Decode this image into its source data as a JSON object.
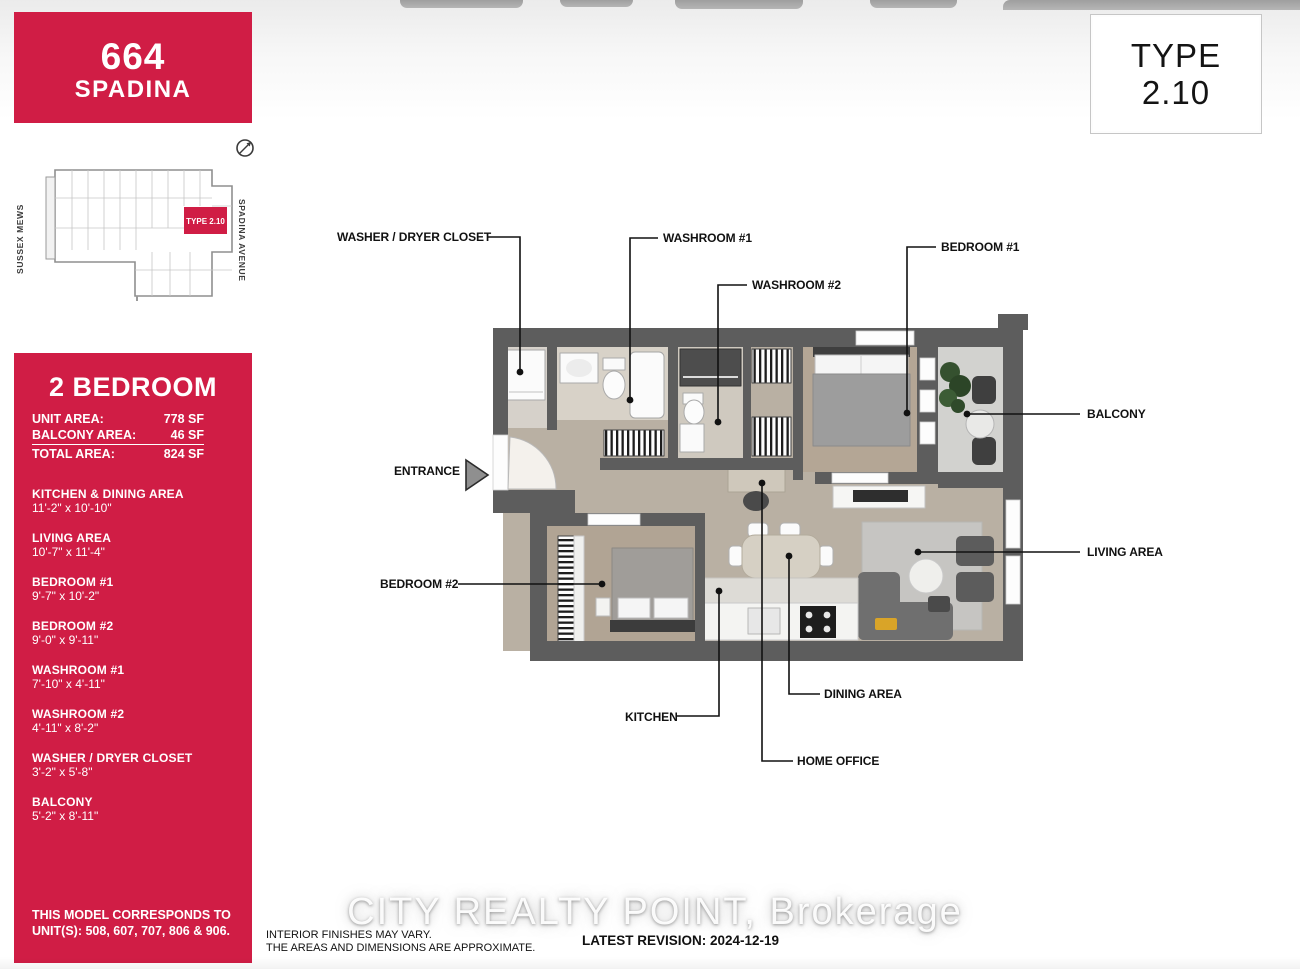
{
  "header": {
    "number": "664",
    "name": "SPADINA"
  },
  "type_box": {
    "word": "TYPE",
    "code": "2.10"
  },
  "key_plan": {
    "unit_label": "TYPE 2.10",
    "street_left": "SUSSEX MEWS",
    "street_right": "SPADINA AVENUE"
  },
  "summary": {
    "title": "2 BEDROOM",
    "areas": [
      {
        "label": "UNIT AREA:",
        "value": "778 SF"
      },
      {
        "label": "BALCONY AREA:",
        "value": "46 SF"
      },
      {
        "label": "TOTAL AREA:",
        "value": "824 SF"
      }
    ],
    "rooms": [
      {
        "name": "KITCHEN & DINING AREA",
        "dims": "11'-2\" x 10'-10\""
      },
      {
        "name": "LIVING AREA",
        "dims": "10'-7\" x 11'-4\""
      },
      {
        "name": "BEDROOM #1",
        "dims": "9'-7\" x 10'-2\""
      },
      {
        "name": "BEDROOM #2",
        "dims": "9'-0\" x 9'-11\""
      },
      {
        "name": "WASHROOM #1",
        "dims": "7'-10\" x 4'-11\""
      },
      {
        "name": "WASHROOM #2",
        "dims": "4'-11\" x 8'-2\""
      },
      {
        "name": "WASHER / DRYER CLOSET",
        "dims": "3'-2\" x 5'-8\""
      },
      {
        "name": "BALCONY",
        "dims": "5'-2\" x 8'-11\""
      }
    ],
    "note_line1": "THIS MODEL CORRESPONDS TO",
    "note_line2": "UNIT(S): 508, 607, 707, 806 & 906."
  },
  "plan_labels": {
    "washer_dryer": "WASHER / DRYER CLOSET",
    "washroom1": "WASHROOM #1",
    "washroom2": "WASHROOM #2",
    "bedroom1": "BEDROOM #1",
    "bedroom2": "BEDROOM #2",
    "balcony": "BALCONY",
    "living": "LIVING AREA",
    "entrance": "ENTRANCE",
    "kitchen": "KITCHEN",
    "dining": "DINING AREA",
    "home_office": "HOME OFFICE"
  },
  "footer": {
    "watermark": "CITY REALTY POINT, Brokerage",
    "disclaimer_line1": "INTERIOR FINISHES MAY VARY.",
    "disclaimer_line2": "THE AREAS AND DIMENSIONS ARE APPROXIMATE.",
    "revision": "LATEST REVISION: 2024-12-19"
  },
  "colors": {
    "brand_red": "#d01d45",
    "wall_gray": "#5d5d5d"
  }
}
